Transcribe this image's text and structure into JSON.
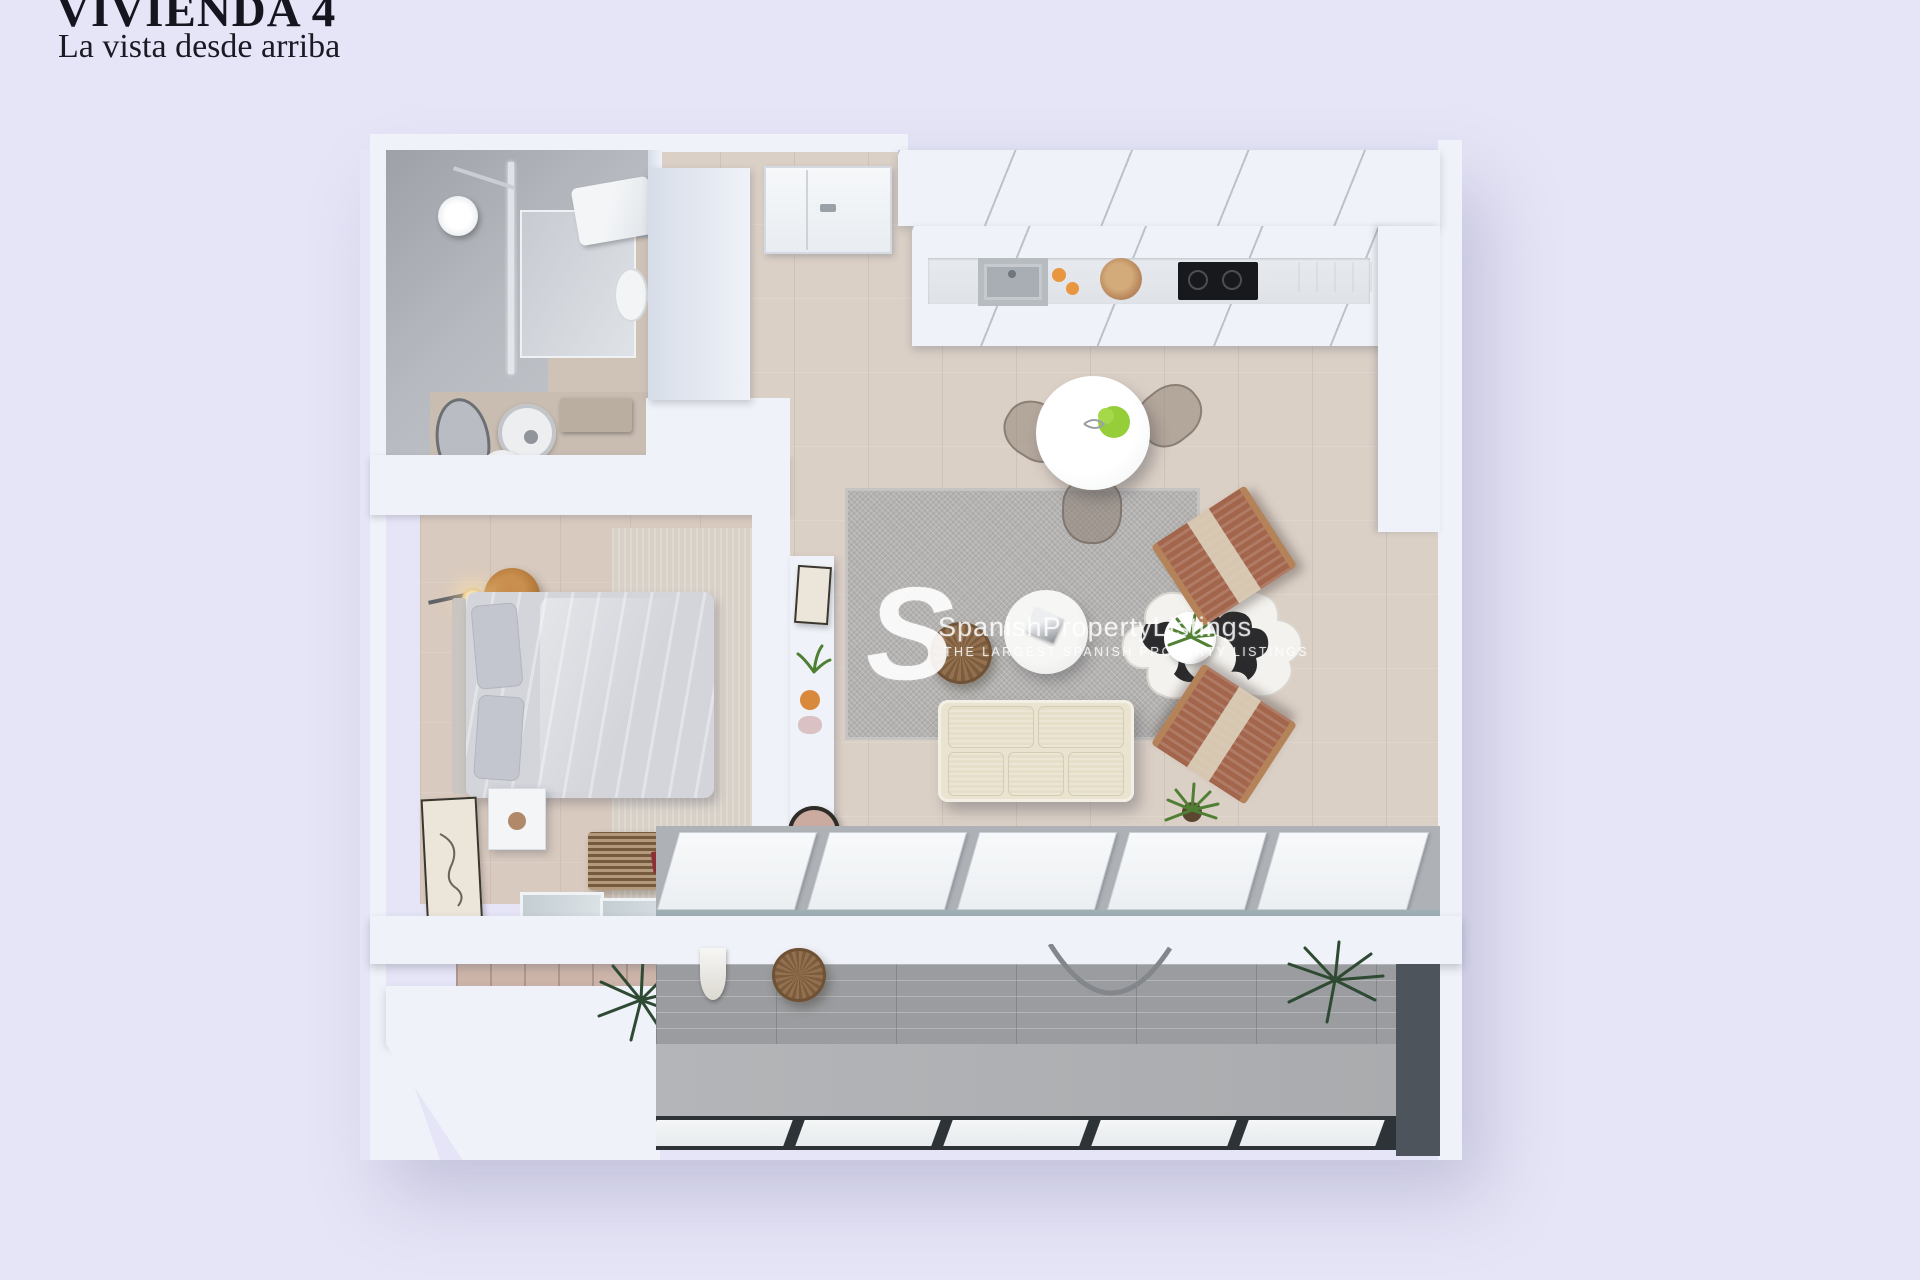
{
  "header": {
    "title": "VIVIENDA 4",
    "subtitle": "La vista desde arriba"
  },
  "watermark": {
    "logo_letter": "S",
    "brand": "SpanishPropertyListings",
    "tagline": "THE LARGEST SPANISH PROPERTY LISTINGS"
  },
  "palette": {
    "background": "#e6e5f7",
    "wall": "#eff2f8",
    "wall-shade": "#d7dde8",
    "bath-grey": "#b6b9bf",
    "tile-beige": "#dbd0c6",
    "bedroom-beige": "#d9cabf",
    "rug-grey": "#b5b3b1",
    "terrace-floor": "#a9abae",
    "terrace-brick": "#9a9c9f",
    "terrace-dark": "#4e545c",
    "sofa-cream": "#e9e3cf",
    "chair-terracotta": "#a3654c",
    "wood": "#b5835a",
    "wood-dark": "#8a6a4b",
    "black": "#17191c",
    "duvet": "#d3d5db",
    "pillow": "#c4c6cf",
    "green": "#4f7f33",
    "green-dark": "#2f4a33",
    "red-accent": "#8e2f35",
    "orange": "#e8963f"
  }
}
